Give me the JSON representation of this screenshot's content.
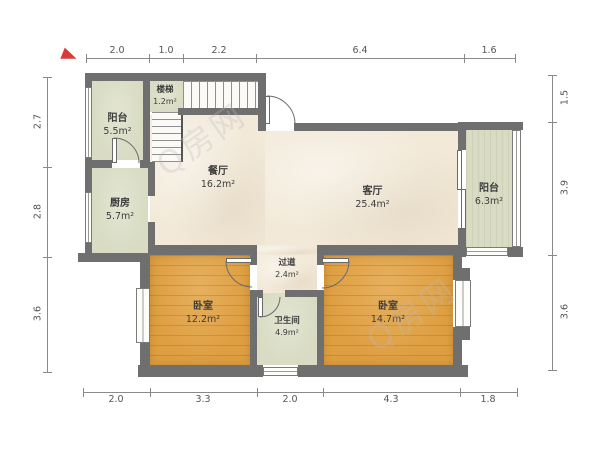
{
  "plan_title": "户型图",
  "rooms": {
    "balcony_left": {
      "name": "阳台",
      "area": "5.5m²"
    },
    "stairs": {
      "name": "楼梯",
      "area": "1.2m²"
    },
    "kitchen": {
      "name": "厨房",
      "area": "5.7m²"
    },
    "dining": {
      "name": "餐厅",
      "area": "16.2m²"
    },
    "living": {
      "name": "客厅",
      "area": "25.4m²"
    },
    "balcony_right": {
      "name": "阳台",
      "area": "6.3m²"
    },
    "bedroom_left": {
      "name": "卧室",
      "area": "12.2m²"
    },
    "hallway": {
      "name": "过道",
      "area": "2.4m²"
    },
    "bathroom": {
      "name": "卫生间",
      "area": "4.9m²"
    },
    "bedroom_right": {
      "name": "卧室",
      "area": "14.7m²"
    }
  },
  "dimensions": {
    "top": [
      "2.0",
      "1.0",
      "2.2",
      "6.4",
      "1.6"
    ],
    "bottom": [
      "2.0",
      "3.3",
      "2.0",
      "4.3",
      "1.8"
    ],
    "left": [
      "2.7",
      "2.8",
      "3.6"
    ],
    "right": [
      "1.5",
      "3.9",
      "3.6"
    ]
  },
  "watermark": {
    "text": "Q房网"
  },
  "colors": {
    "wall": "#6f6f6f",
    "floor_main": "#f2e9d8",
    "floor_balcony": "#d9dcc3",
    "floor_bedroom": "#de9e41",
    "dimension_text": "#555555",
    "compass": "#d93a3a"
  }
}
